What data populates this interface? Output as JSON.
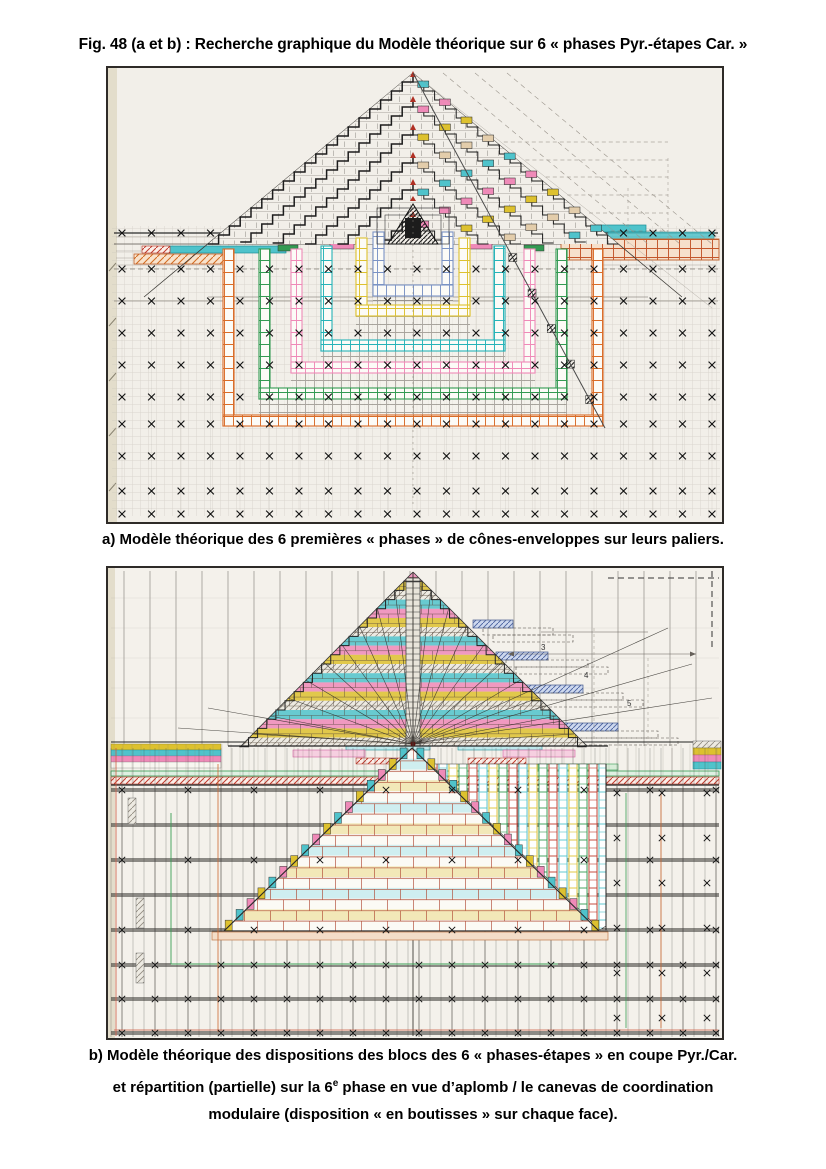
{
  "title": "Fig. 48 (a et b) : Recherche graphique du Modèle théorique sur 6 « phases Pyr.-étapes Car. »",
  "captions": {
    "a": "a) Modèle théorique des 6 premières « phases » de cônes-enveloppes sur leurs paliers.",
    "b_line1": "b) Modèle théorique des dispositions des blocs des 6 « phases-étapes » en coupe Pyr./Car.",
    "b_line2_pre": "et répartition (partielle) sur la 6",
    "b_line2_sup": "e",
    "b_line2_post": " phase en vue d’aplomb / le canevas de coordination",
    "b_line3": "modulaire (disposition « en boutisses » sur chaque face)."
  },
  "figure_a": {
    "phase_count": 6,
    "phase_order": [
      "orange",
      "green",
      "pink",
      "teal",
      "yellow",
      "blue"
    ],
    "edge_block_cycle": [
      "cyan",
      "pink",
      "yellow",
      "tan"
    ]
  },
  "figure_b": {
    "phase_count": 6,
    "course_cycle": [
      "pink",
      "yellow",
      "hatch",
      "cyan"
    ],
    "lower_cycle": [
      "white",
      "cyan",
      "white",
      "yellow"
    ],
    "stripe_colors": [
      "red",
      "cyan",
      "yellow",
      "green"
    ],
    "step_labels": [
      "3",
      "4",
      "5"
    ],
    "course_counts": {
      "upper": 19,
      "lower": 17
    }
  },
  "palette": {
    "cyan": "#4fc3cb",
    "teal": "#27b3b8",
    "pink": "#ef8ab8",
    "magenta": "#d95f9f",
    "yellow": "#ddc12f",
    "orange": "#d96c28",
    "green": "#339a52",
    "blue": "#7b93c5",
    "red": "#c0392b",
    "tan": "#e3cdab",
    "salmon": "#edb08a",
    "blue_hatch": "#8aa0cc",
    "dark": "#1d1d1d",
    "paper": "#f2efe9"
  }
}
